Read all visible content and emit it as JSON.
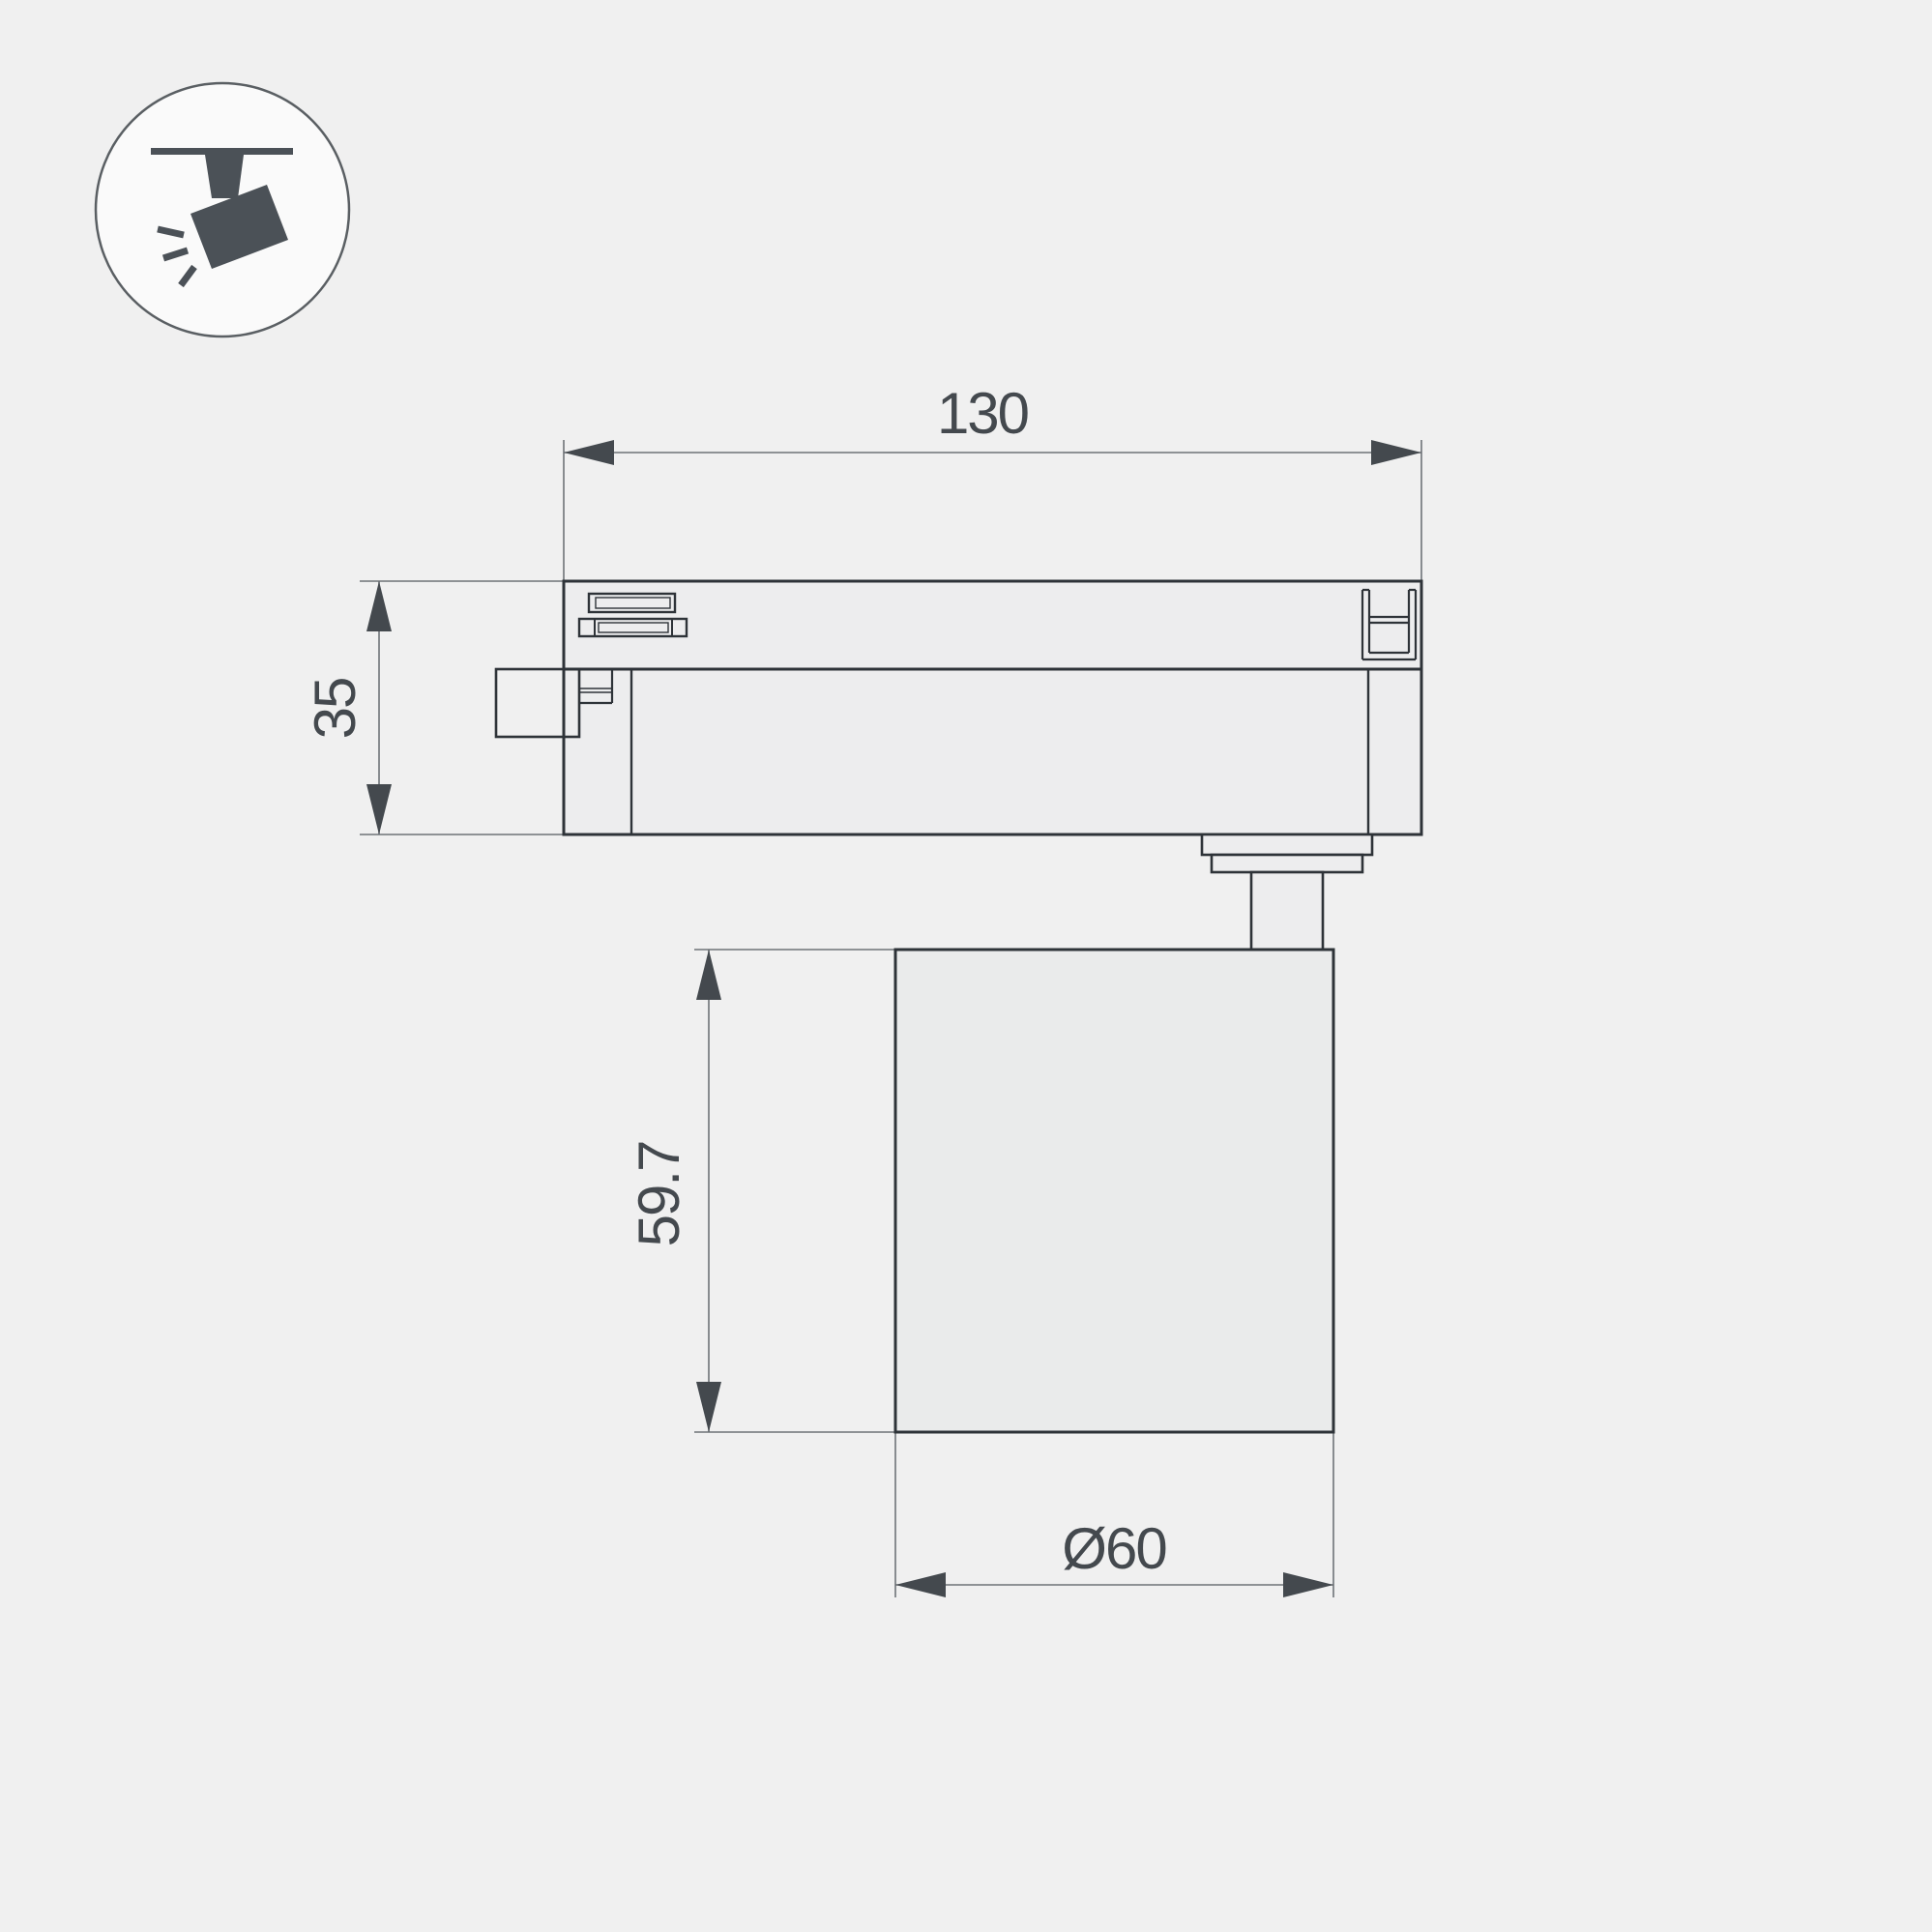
{
  "page": {
    "background_color": "#f0f0f0",
    "outline_color": "#2e3338",
    "thin_line_color": "#6e7377",
    "dimension_color": "#44494e",
    "icon_color": "#4b5157",
    "shape_fill": "#ededee"
  },
  "icon": {
    "name": "ceiling-track-spotlight-pictogram"
  },
  "drawing": {
    "subject": "track light fixture side-view technical drawing",
    "views": [
      "track adapter with clips",
      "cylindrical lamp body on pivot stem"
    ]
  },
  "dimensions": {
    "adapter_length": "130",
    "adapter_height": "35",
    "body_height": "59.7",
    "body_diameter": "Ø60"
  }
}
